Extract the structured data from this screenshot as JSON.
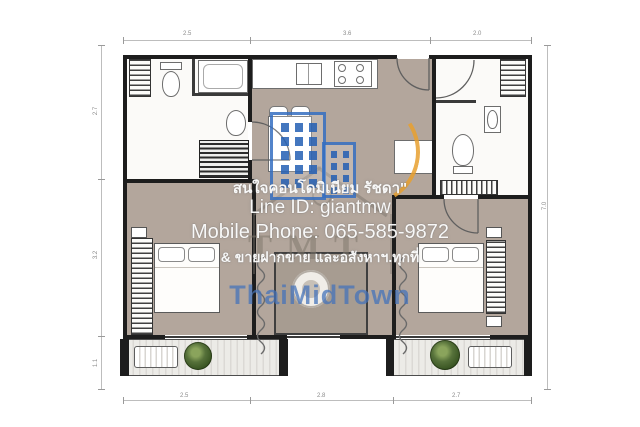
{
  "watermark": {
    "line1": "สนใจคอนโดมิเนียม รัชดา\"",
    "line2": "Line ID: giantmw",
    "line3": "Mobile Phone: 065-585-9872",
    "line4": "& ขายฝากขาย และอสังหาฯ.ทุกที่",
    "brand": "ThaiMidTown",
    "logo_monogram": "TMT",
    "colors": {
      "brand_blue": "#5c87c5",
      "logo_blue": "#2a6fc0",
      "logo_orange": "#eaa02f",
      "text": "#ffffff"
    }
  },
  "floor_plan": {
    "description": "2-bedroom 2-bathroom condominium unit floor plan with central living-dining area, kitchen at top, two balconies with plants and A/C units at bottom",
    "dimensions": {
      "top": [
        "2.5",
        "3.6",
        "2.0"
      ],
      "bottom": [
        "2.5",
        "2.8",
        "2.7"
      ],
      "left": [
        "2.7",
        "3.2",
        "1.1"
      ],
      "right": [
        "7.0"
      ]
    },
    "colors": {
      "floor_tan": "#b3a69c",
      "wall": "#1d1d1d",
      "balcony": "#e7e5e1",
      "plant": "#4f6b2e"
    }
  }
}
